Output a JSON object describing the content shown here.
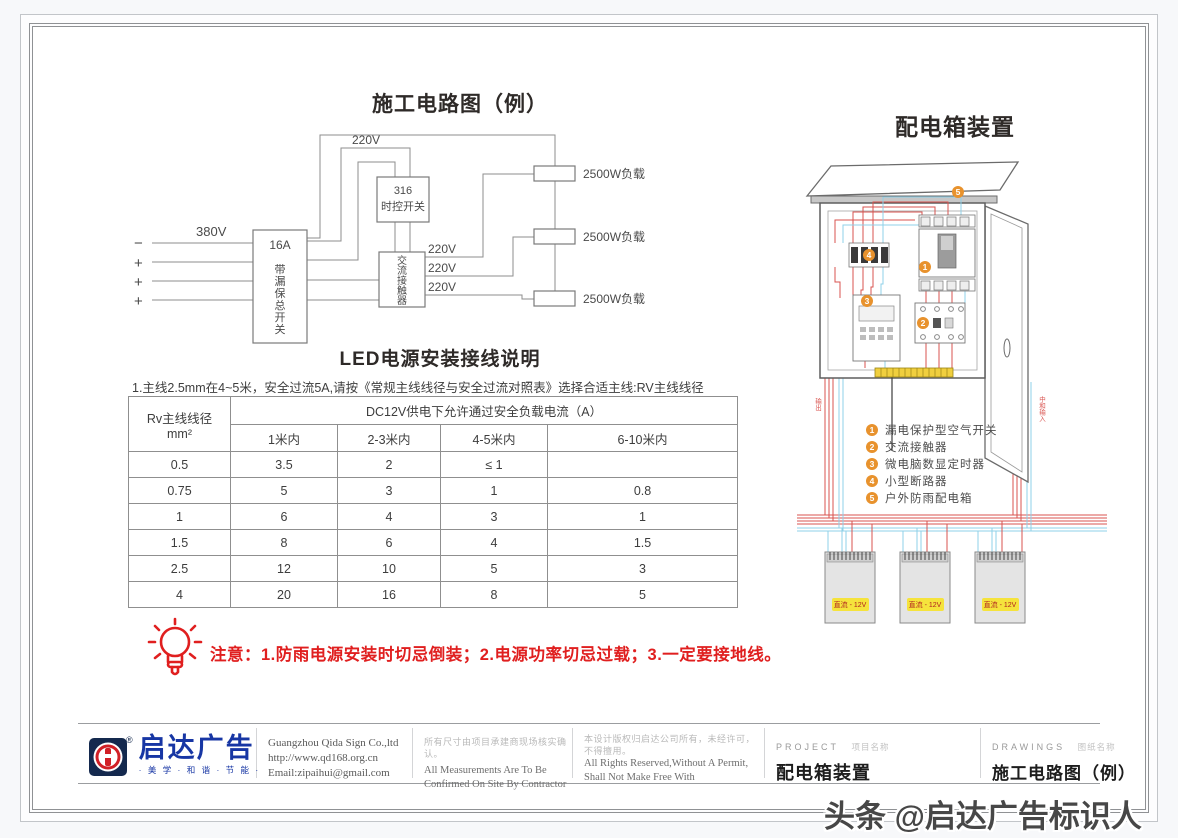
{
  "circuit": {
    "title": "施工电路图（例）",
    "labels": {
      "input_voltage": "380V",
      "minus": "−",
      "plus": "+",
      "breaker_rating": "16A",
      "breaker_name_chars": [
        "带",
        "漏",
        "保",
        "总",
        "开",
        "关"
      ],
      "timer_model": "316",
      "timer_name": "时控开关",
      "contactor_chars": [
        "交",
        "流",
        "接",
        "触",
        "器"
      ],
      "v220": "220V",
      "load": "2500W负载"
    }
  },
  "led_section": {
    "title": "LED电源安装接线说明",
    "note": "1.主线2.5mm在4~5米，安全过流5A,请按《常规主线线径与安全过流对照表》选择合适主线:RV主线线径",
    "table": {
      "col1_header_line1": "Rv主线线径",
      "col1_header_line2": "mm²",
      "span_header": "DC12V供电下允许通过安全负载电流（A）",
      "sub_headers": [
        "1米内",
        "2-3米内",
        "4-5米内",
        "6-10米内"
      ],
      "rows": [
        [
          "0.5",
          "3.5",
          "2",
          "≤ 1",
          ""
        ],
        [
          "0.75",
          "5",
          "3",
          "1",
          "0.8"
        ],
        [
          "1",
          "6",
          "4",
          "3",
          "1"
        ],
        [
          "1.5",
          "8",
          "6",
          "4",
          "1.5"
        ],
        [
          "2.5",
          "12",
          "10",
          "5",
          "3"
        ],
        [
          "4",
          "20",
          "16",
          "8",
          "5"
        ]
      ]
    },
    "warning": "注意：1.防雨电源安装时切忌倒装；2.电源功率切忌过载；3.一定要接地线。"
  },
  "distribution": {
    "title": "配电箱装置",
    "legend": [
      {
        "num": "1",
        "label": "漏电保护型空气开关"
      },
      {
        "num": "2",
        "label": "交流接触器"
      },
      {
        "num": "3",
        "label": "微电脑数显定时器"
      },
      {
        "num": "4",
        "label": "小型断路器"
      },
      {
        "num": "5",
        "label": "户外防雨配电箱"
      }
    ],
    "psu_label": "直流 - 12V",
    "wire_label_left": "输出",
    "wire_label_right": "中和输入"
  },
  "titleblock": {
    "logo_text": "启达广告",
    "logo_reg": "®",
    "logo_tagline": "· 美 学 · 和 谐 · 节 能 ·",
    "company": "Guangzhou Qida Sign Co.,ltd",
    "website": "http://www.qd168.org.cn",
    "email": "Email:zipaihui@gmail.com",
    "measure_cn": "所有尺寸由项目承建商现场核实确认。",
    "measure_en1": "All Measurements Are To Be",
    "measure_en2": "Confirmed On Site By Contractor",
    "rights_cn1": "本设计版权归启达公司所有，未经许可，",
    "rights_cn2": "不得擅用。",
    "rights_en1": "All Rights Reserved,Without A Permit,",
    "rights_en2": "Shall Not Make Free With",
    "project_label": "PROJECT",
    "project_sub": "项目名称",
    "project_value": "配电箱装置",
    "drawings_label": "DRAWINGS",
    "drawings_sub": "图纸名称",
    "drawings_value": "施工电路图（例）"
  },
  "watermark": "头条 @启达广告标识人"
}
